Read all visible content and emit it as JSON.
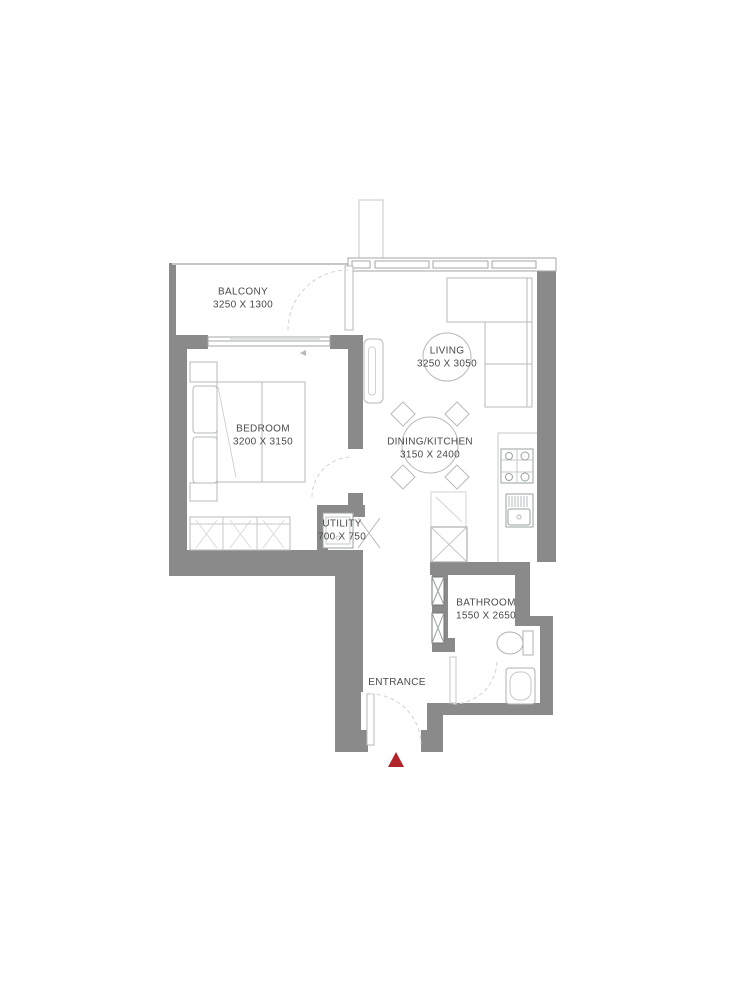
{
  "plan": {
    "rooms": [
      {
        "name": "BALCONY",
        "dims": "3250 X 1300"
      },
      {
        "name": "LIVING",
        "dims": "3250 X 3050"
      },
      {
        "name": "BEDROOM",
        "dims": "3200 X 3150"
      },
      {
        "name": "DINING/KITCHEN",
        "dims": "3150 X 2400"
      },
      {
        "name": "UTILITY",
        "dims": "700 X 750"
      },
      {
        "name": "BATHROOM",
        "dims": "1550 X 2650"
      },
      {
        "name": "ENTRANCE",
        "dims": ""
      }
    ],
    "entrance_marker": {
      "shape": "triangle-up",
      "color": "#b2242c"
    },
    "colors": {
      "wall": "#8a8a8a",
      "furniture_line": "#b5b9bb",
      "dashed_arc": "#cfd2d4",
      "window_line": "#a3a6a8",
      "text": "#4a4a4a",
      "background": "#ffffff"
    },
    "fixtures": [
      "l-sofa-icon",
      "dining-table-icon",
      "dining-chair-icon",
      "bed-icon",
      "pillow-icon",
      "nightstand-icon",
      "wardrobe-icon",
      "mirror-unit-icon",
      "stove-icon",
      "kitchen-sink-icon",
      "fridge-icon",
      "duct-shaft-x-icon",
      "washing-machine-icon",
      "bifold-door-icon",
      "toilet-icon",
      "vanity-sink-icon",
      "door-swing-arc",
      "window-band",
      "service-shaft"
    ]
  }
}
